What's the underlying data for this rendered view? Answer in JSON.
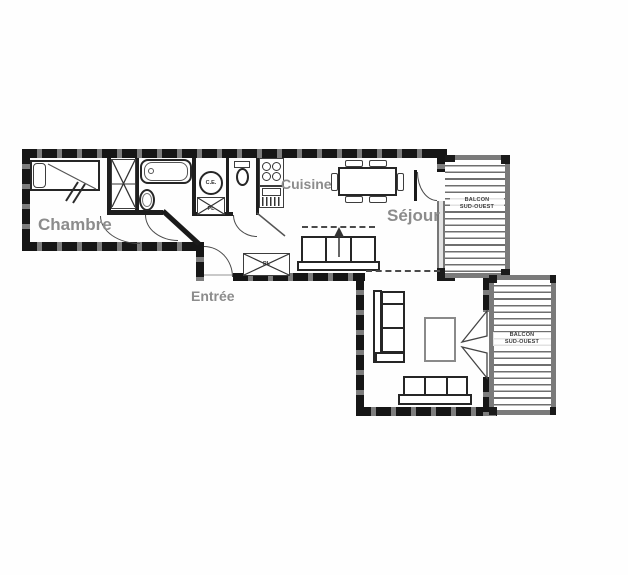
{
  "plan": {
    "rooms": {
      "chambre": "Chambre",
      "cuisine": "Cuisine",
      "sejour": "Séjour",
      "entree": "Entrée"
    },
    "fixtures": {
      "water_heater": "C.E.",
      "closet_bathroom": "PL",
      "closet_entree": "PL"
    },
    "balconies": {
      "top": {
        "line1": "BALCON",
        "line2": "SUD-OUEST"
      },
      "bottom": {
        "line1": "BALCON",
        "line2": "SUD-OUEST"
      }
    },
    "colors": {
      "wall_dark": "#161616",
      "wall_mid": "#7d7d7d",
      "balcony_rail": "#7a7a7a",
      "hatch_line": "#6f6f6f",
      "label_gray": "#8c8c8c",
      "line": "#3d3d3d",
      "background": "#ffffff"
    }
  }
}
